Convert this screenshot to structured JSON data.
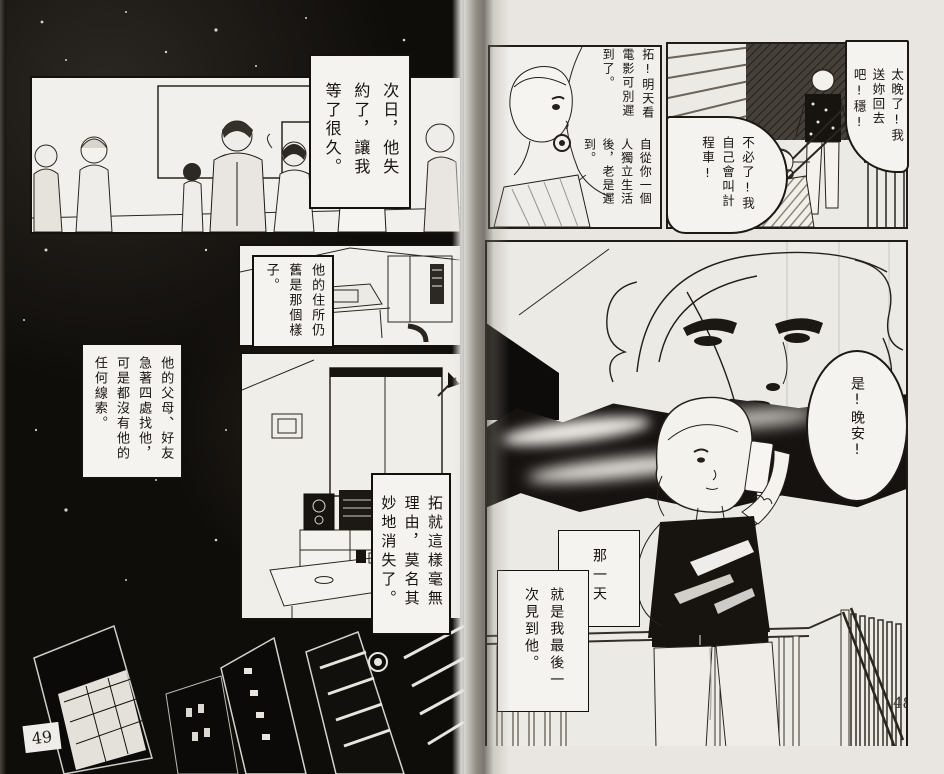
{
  "colors": {
    "paper": "#e9e6e1",
    "panel_white": "#f2f0ec",
    "ink": "#17130f",
    "page_black": "#0f0d0a"
  },
  "page_left": {
    "page_number": "49",
    "caption_next_day": "次日，他失約了，讓我等了很久。",
    "caption_residence": "他的住所仍舊是那個樣子。",
    "caption_search": "他的父母、好友急著四處找他，可是都沒有他的任何線索。",
    "caption_vanished": "拓就這樣毫無理由，莫名其妙地消失了。"
  },
  "page_right": {
    "page_number": "48",
    "bubble_too_late": "太晚了!我送妳回去吧!穩!",
    "bubble_movie": "拓!明天看電影可別遲到了。",
    "bubble_always_late": "自從你一個人獨立生活後，老是遲到。",
    "bubble_taxi": "不必了!我自己會叫計程車!",
    "bubble_goodnight": "是!晚安!",
    "caption_that_day": "那一天",
    "caption_last_time": "就是我最後一次見到他。"
  }
}
